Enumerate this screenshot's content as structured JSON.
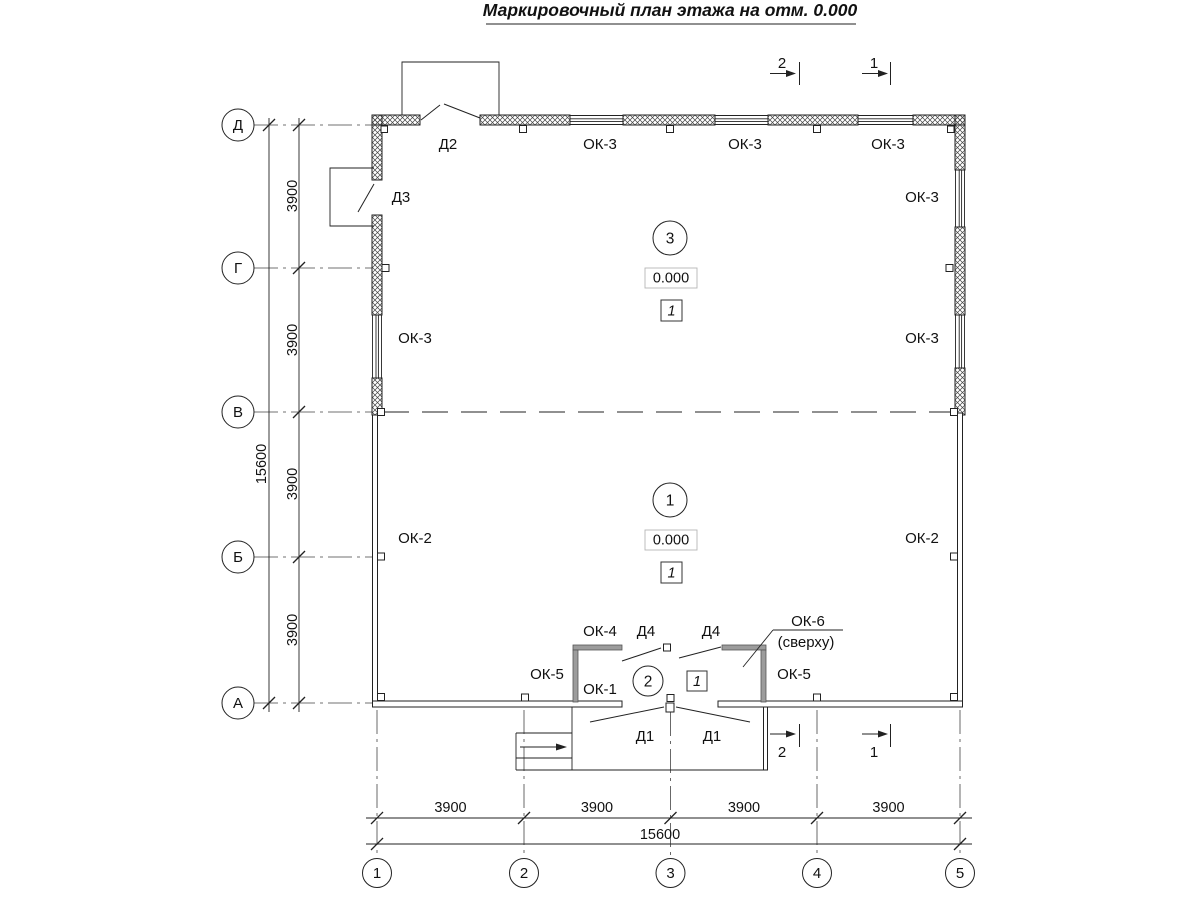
{
  "title": "Маркировочный план этажа на отм. 0.000",
  "axes": {
    "rows": [
      "Д",
      "Г",
      "В",
      "Б",
      "А"
    ],
    "cols": [
      "1",
      "2",
      "3",
      "4",
      "5"
    ]
  },
  "dims": {
    "bottom_segments": [
      "3900",
      "3900",
      "3900",
      "3900"
    ],
    "bottom_total": "15600",
    "left_segments": [
      "3900",
      "3900",
      "3900",
      "3900"
    ],
    "left_total": "15600"
  },
  "sections": {
    "s1": "1",
    "s2": "2"
  },
  "rooms": {
    "room3": {
      "number": "3",
      "elevation": "0.000",
      "floor_type": "1"
    },
    "room1": {
      "number": "1",
      "elevation": "0.000",
      "floor_type": "1"
    },
    "room2": {
      "number": "2",
      "floor_type": "1"
    }
  },
  "marks": {
    "d1": "Д1",
    "d2": "Д2",
    "d3": "Д3",
    "d4": "Д4",
    "ok1": "ОК-1",
    "ok2": "ОК-2",
    "ok3": "ОК-3",
    "ok4": "ОК-4",
    "ok5": "ОК-5",
    "ok6": "ОК-6",
    "ok6_note": "(сверху)"
  }
}
